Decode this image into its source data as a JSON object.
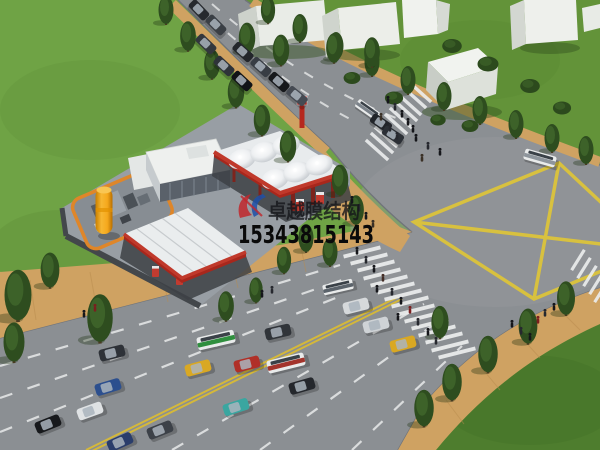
{
  "watermark": {
    "brand_text": "卓越膜结构",
    "phone_number": "15343815143",
    "logo_colors": {
      "blue": "#1d4fa8",
      "red": "#c1272d"
    }
  },
  "scene": {
    "type": "3D architectural rendering, aerial view",
    "subject": "Membrane-structure gas station canopy beside a multi-lane road intersection",
    "elements": [
      "white tensile membrane canopy with six conical peaks and red trim",
      "secondary ridged membrane canopy with red trim",
      "station shop building",
      "equipment yard with orange pipe fence and yellow fuel tank",
      "intersection with yellow box-junction marking",
      "zebra crosswalks with pedestrians",
      "multi-lane roads with cars and buses",
      "tan brick sidewalks lined with poplar trees",
      "white low-rise buildings on lawns"
    ]
  },
  "colors": {
    "grass": "#68993f",
    "grass_dark": "#4e7d2e",
    "asphalt": "#8b8f93",
    "sidewalk_tan": "#cfa262",
    "canopy_white": "#e8ebed",
    "canopy_trim_red": "#c0392b",
    "marking_yellow": "#dcc33a",
    "marking_white": "#e8eaea",
    "building_white": "#eef0ec",
    "tree_green": "#2e4d1f",
    "tank_yellow": "#f5a81c"
  }
}
